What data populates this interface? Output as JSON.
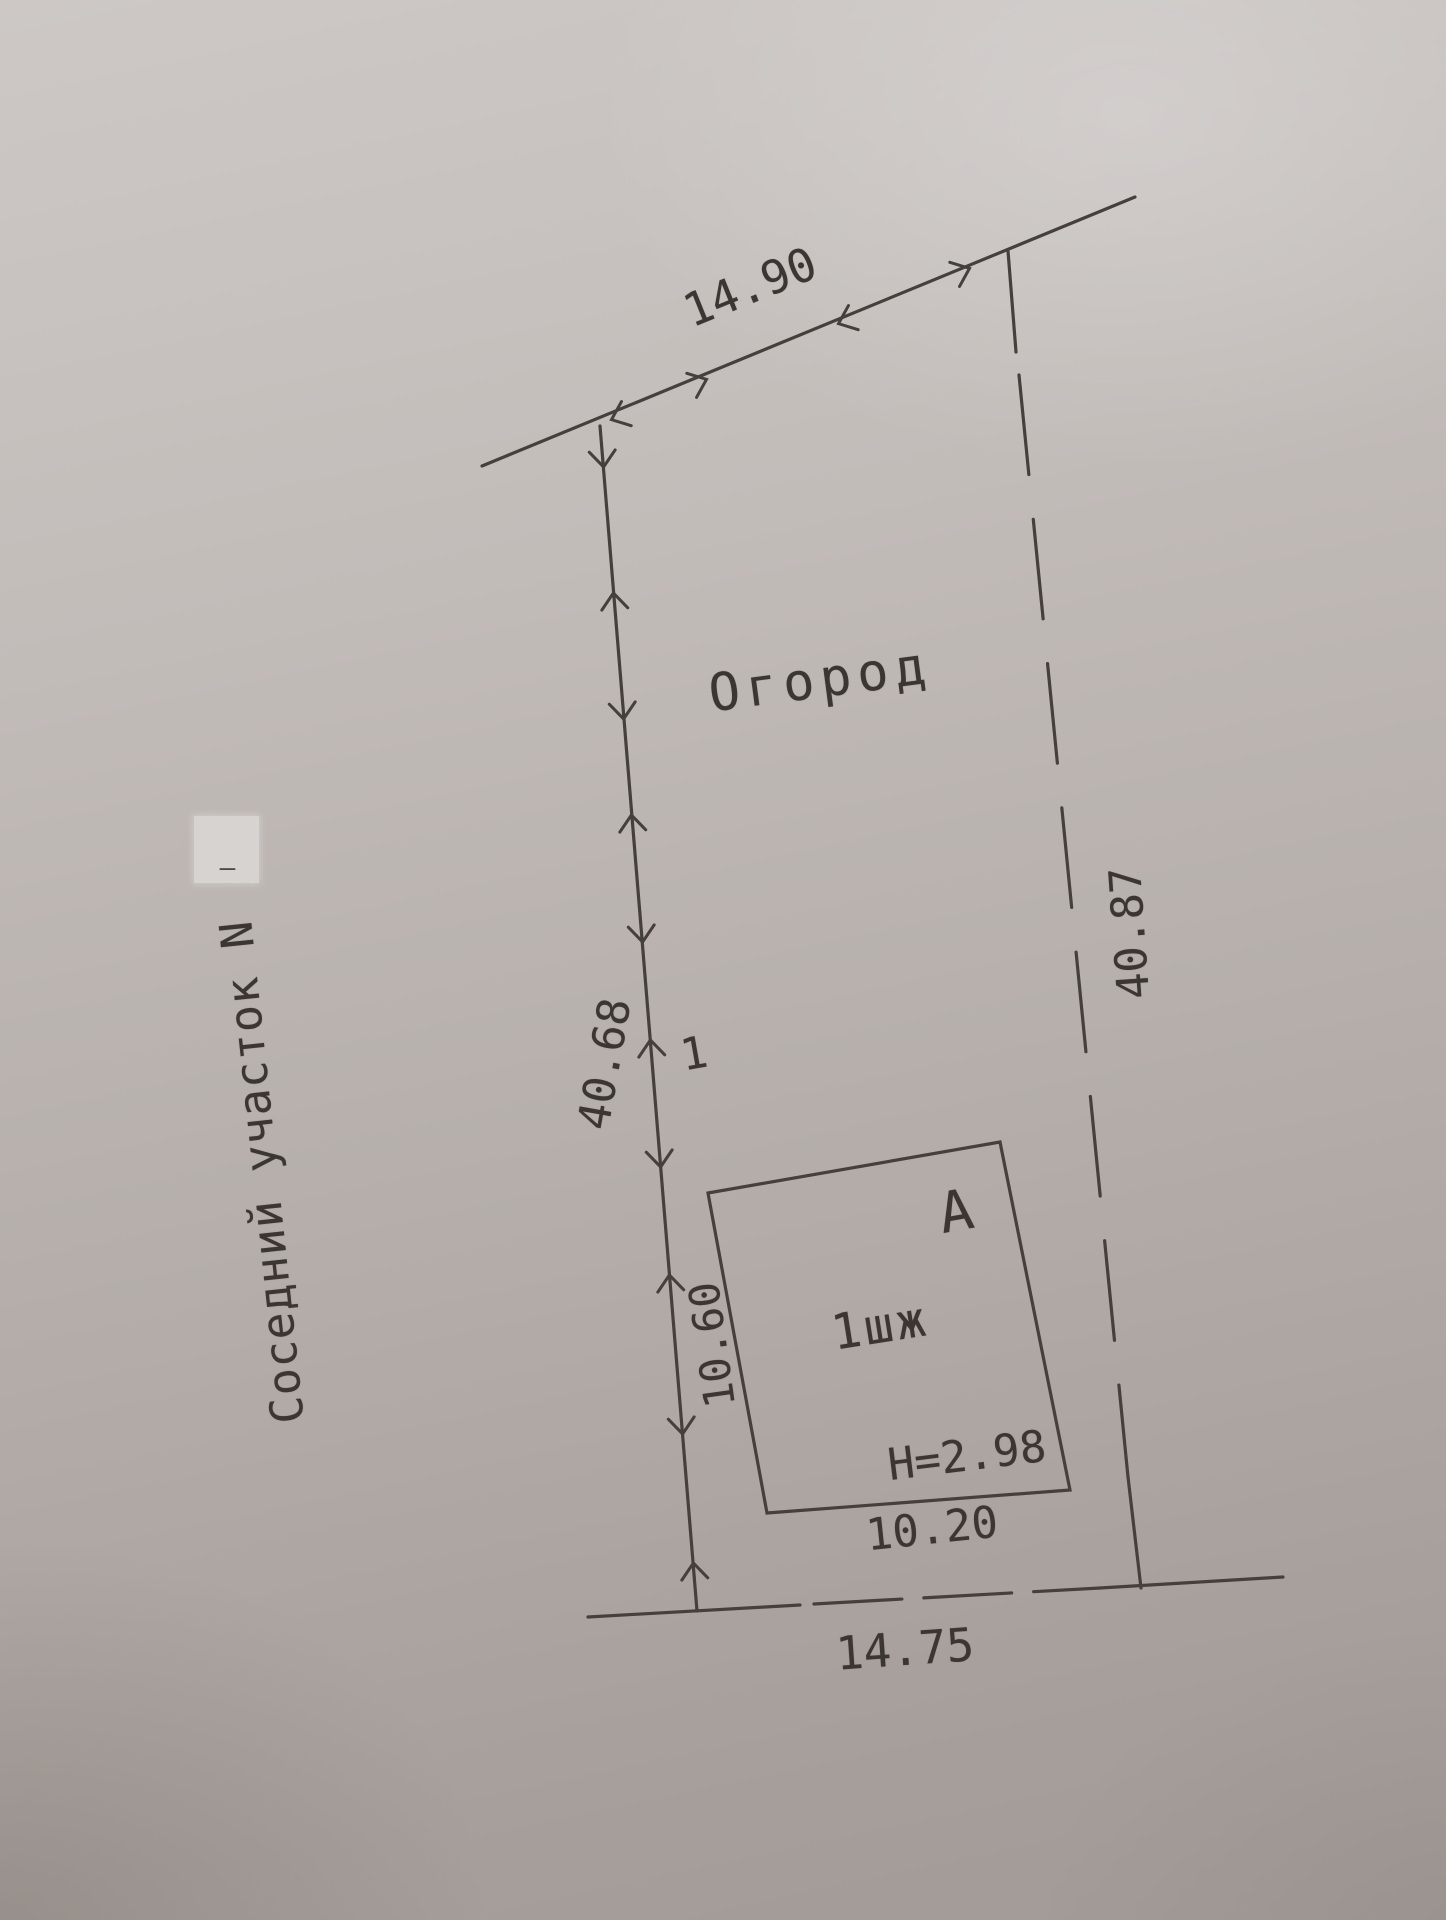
{
  "document": {
    "type_hint": "photographed cadastral site plan sketch",
    "language": "ru"
  },
  "labels": {
    "top_boundary_length": "14.90",
    "left_boundary_length": "40.68",
    "right_boundary_length": "40.87",
    "bottom_boundary_length": "14.75",
    "garden_area": "Огород",
    "neighbor_plot": "Соседний участок N",
    "survey_point_number": "1",
    "building_side_length": "10.60",
    "building_bottom_length": "10.20",
    "building_height": "H=2.98",
    "building_designation": "1шж",
    "building_letter": "А",
    "redaction_mark": "—"
  },
  "colors": {
    "ink": "#45403b",
    "text": "#3b3632",
    "paper_light": "#cdc8c6",
    "paper_dark": "#a29a96",
    "redaction_patch": "#d6d3d0"
  }
}
